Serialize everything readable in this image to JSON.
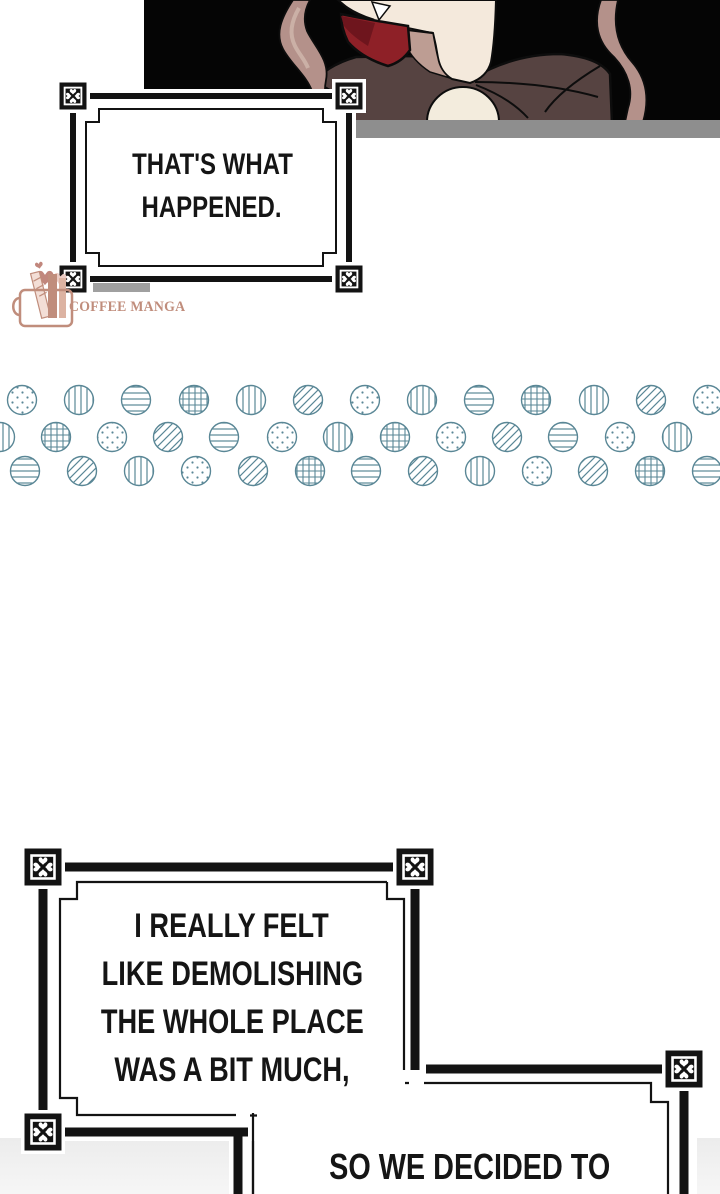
{
  "page": {
    "width": 720,
    "height": 1194,
    "background": "#ffffff"
  },
  "colors": {
    "panel_bg": "#050505",
    "floor": "#8e8e8e",
    "coat": "#564341",
    "skin": "#f4e9dc",
    "skin_shadow": "#bd9d93",
    "shirt": "#f3ecdd",
    "scarf": "#8e2027",
    "scarf_dark": "#6e151d",
    "hair": "#b4918a",
    "hair_light": "#cbb0a6",
    "outline": "#0d0d0d",
    "box_border": "#131313",
    "box_fill": "#ffffff",
    "divider": "#5a8796",
    "text": "#151515",
    "watermark": "#c08d7c",
    "watermark_heart": "#c1877d",
    "watermark_heart_light": "#ecccc4",
    "shadow_bar": "#a0a0a0",
    "fade_top": "#ececec",
    "fade_bottom": "#f6f6f6"
  },
  "speech": {
    "box1": {
      "lines": [
        "THAT'S WHAT",
        "HAPPENED."
      ]
    },
    "box2": {
      "lines": [
        "I REALLY FELT",
        "LIKE DEMOLISHING",
        "THE WHOLE PLACE",
        "WAS A BIT MUCH,"
      ]
    },
    "box3": {
      "lines": [
        "SO WE DECIDED TO"
      ]
    }
  },
  "watermark": {
    "label": "COFFEE MANGA"
  },
  "divider": {
    "radius": 14.5,
    "rows": [
      {
        "cy": 400,
        "circles": [
          {
            "x": 22,
            "p": "dots"
          },
          {
            "x": 79,
            "p": "v"
          },
          {
            "x": 136,
            "p": "h"
          },
          {
            "x": 194,
            "p": "grid"
          },
          {
            "x": 251,
            "p": "v"
          },
          {
            "x": 308,
            "p": "diag"
          },
          {
            "x": 365,
            "p": "dots"
          },
          {
            "x": 422,
            "p": "v"
          },
          {
            "x": 479,
            "p": "h"
          },
          {
            "x": 536,
            "p": "grid"
          },
          {
            "x": 594,
            "p": "v"
          },
          {
            "x": 651,
            "p": "diag"
          },
          {
            "x": 708,
            "p": "dots"
          }
        ]
      },
      {
        "cy": 437,
        "circles": [
          {
            "x": 0,
            "p": "v"
          },
          {
            "x": 56,
            "p": "grid"
          },
          {
            "x": 112,
            "p": "dots"
          },
          {
            "x": 168,
            "p": "diag"
          },
          {
            "x": 224,
            "p": "h"
          },
          {
            "x": 282,
            "p": "dots"
          },
          {
            "x": 338,
            "p": "v"
          },
          {
            "x": 395,
            "p": "grid"
          },
          {
            "x": 451,
            "p": "dots"
          },
          {
            "x": 507,
            "p": "diag"
          },
          {
            "x": 563,
            "p": "h"
          },
          {
            "x": 620,
            "p": "dots"
          },
          {
            "x": 677,
            "p": "v"
          }
        ]
      },
      {
        "cy": 471,
        "circles": [
          {
            "x": 25,
            "p": "h"
          },
          {
            "x": 82,
            "p": "diag"
          },
          {
            "x": 139,
            "p": "v"
          },
          {
            "x": 196,
            "p": "dots"
          },
          {
            "x": 253,
            "p": "diag"
          },
          {
            "x": 310,
            "p": "grid"
          },
          {
            "x": 366,
            "p": "h"
          },
          {
            "x": 423,
            "p": "diag"
          },
          {
            "x": 480,
            "p": "v"
          },
          {
            "x": 537,
            "p": "dots"
          },
          {
            "x": 593,
            "p": "diag"
          },
          {
            "x": 650,
            "p": "grid"
          },
          {
            "x": 707,
            "p": "h"
          }
        ]
      }
    ]
  }
}
